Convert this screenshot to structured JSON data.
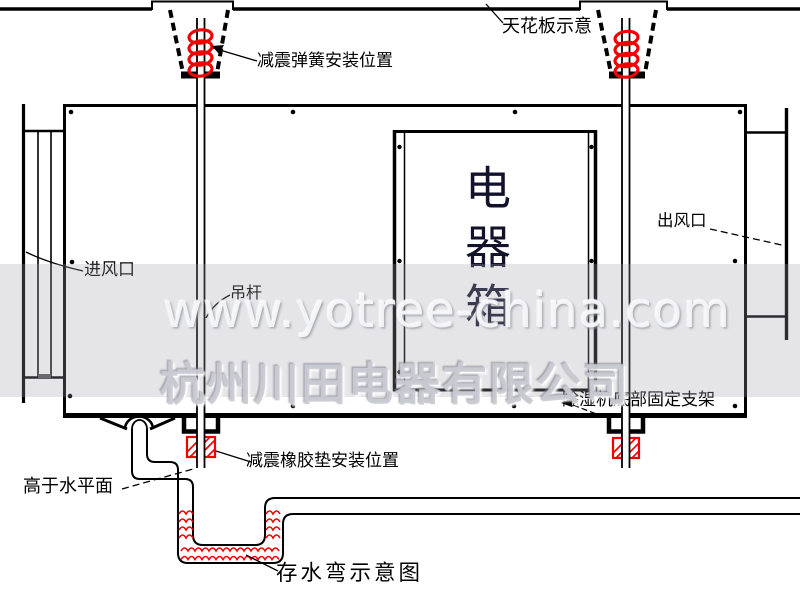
{
  "diagram": {
    "labels": {
      "ceiling": "天花板示意",
      "spring_mount": "减震弹簧安装位置",
      "air_inlet": "进风口",
      "hanger_rod": "吊杆",
      "air_outlet": "出风口",
      "electric_box": "电器箱",
      "bottom_bracket": "除湿机底部固定支架",
      "rubber_pad_mount": "减震橡胶垫安装位置",
      "above_water_level": "高于水平面",
      "water_trap": "存水弯示意图"
    },
    "colors": {
      "line": "#000000",
      "highlight_red": "#f20000",
      "watermark_gray": "#cbccd3"
    }
  },
  "watermark": {
    "url": "www.yotree-china.com",
    "company": "杭州川田电器有限公司"
  }
}
